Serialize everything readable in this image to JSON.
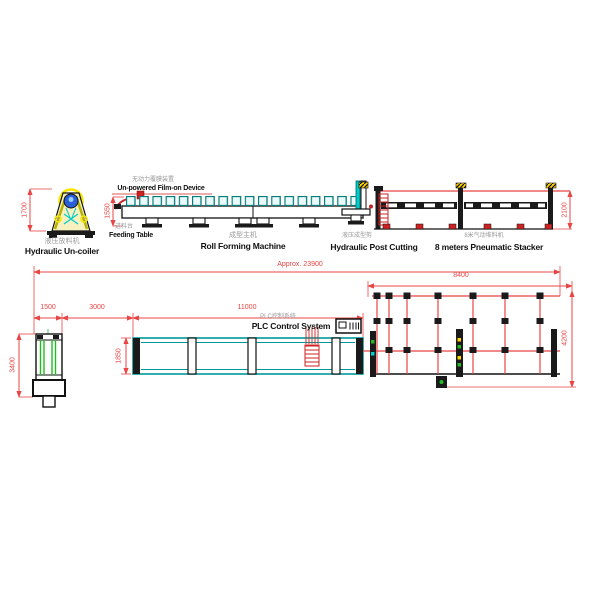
{
  "labels": {
    "uncoiler": {
      "cn": "液压放料机",
      "en": "Hydraulic Un-coiler"
    },
    "film_device": {
      "cn": "无动力覆膜装置",
      "en": "Un-powered Film-on Device"
    },
    "feeding_table": {
      "cn": "进料台",
      "en": "Feeding Table"
    },
    "roll_former": {
      "cn": "成型主机",
      "en": "Roll Forming Machine"
    },
    "post_cutting": {
      "cn": "液压成型剪",
      "en": "Hydraulic Post Cutting"
    },
    "stacker": {
      "cn": "8米气动堆料机",
      "en": "8 meters Pneumatic Stacker"
    },
    "plc": {
      "cn": "PLC控制系统",
      "en": "PLC Control System"
    }
  },
  "dimensions": {
    "overall_length": "Approx. 23900",
    "uncoiler_height": "1700",
    "infeed_height": "1550",
    "stacker_height": "2100",
    "uncoiler_length": "1500",
    "uncoiler_to_machine": "3000",
    "machine_length": "11000",
    "stacker_length": "8400",
    "uncoiler_width": "3400",
    "machine_width": "1850",
    "stacker_width": "4200"
  },
  "colors": {
    "dimension_red": "#e84545",
    "machine_teal": "#009999",
    "alert_red": "#cc2222",
    "coil_blue": "#2b5fd9",
    "frame_yellow": "#b8b000",
    "stripe_green": "#22bb22",
    "line_black": "#111111"
  }
}
